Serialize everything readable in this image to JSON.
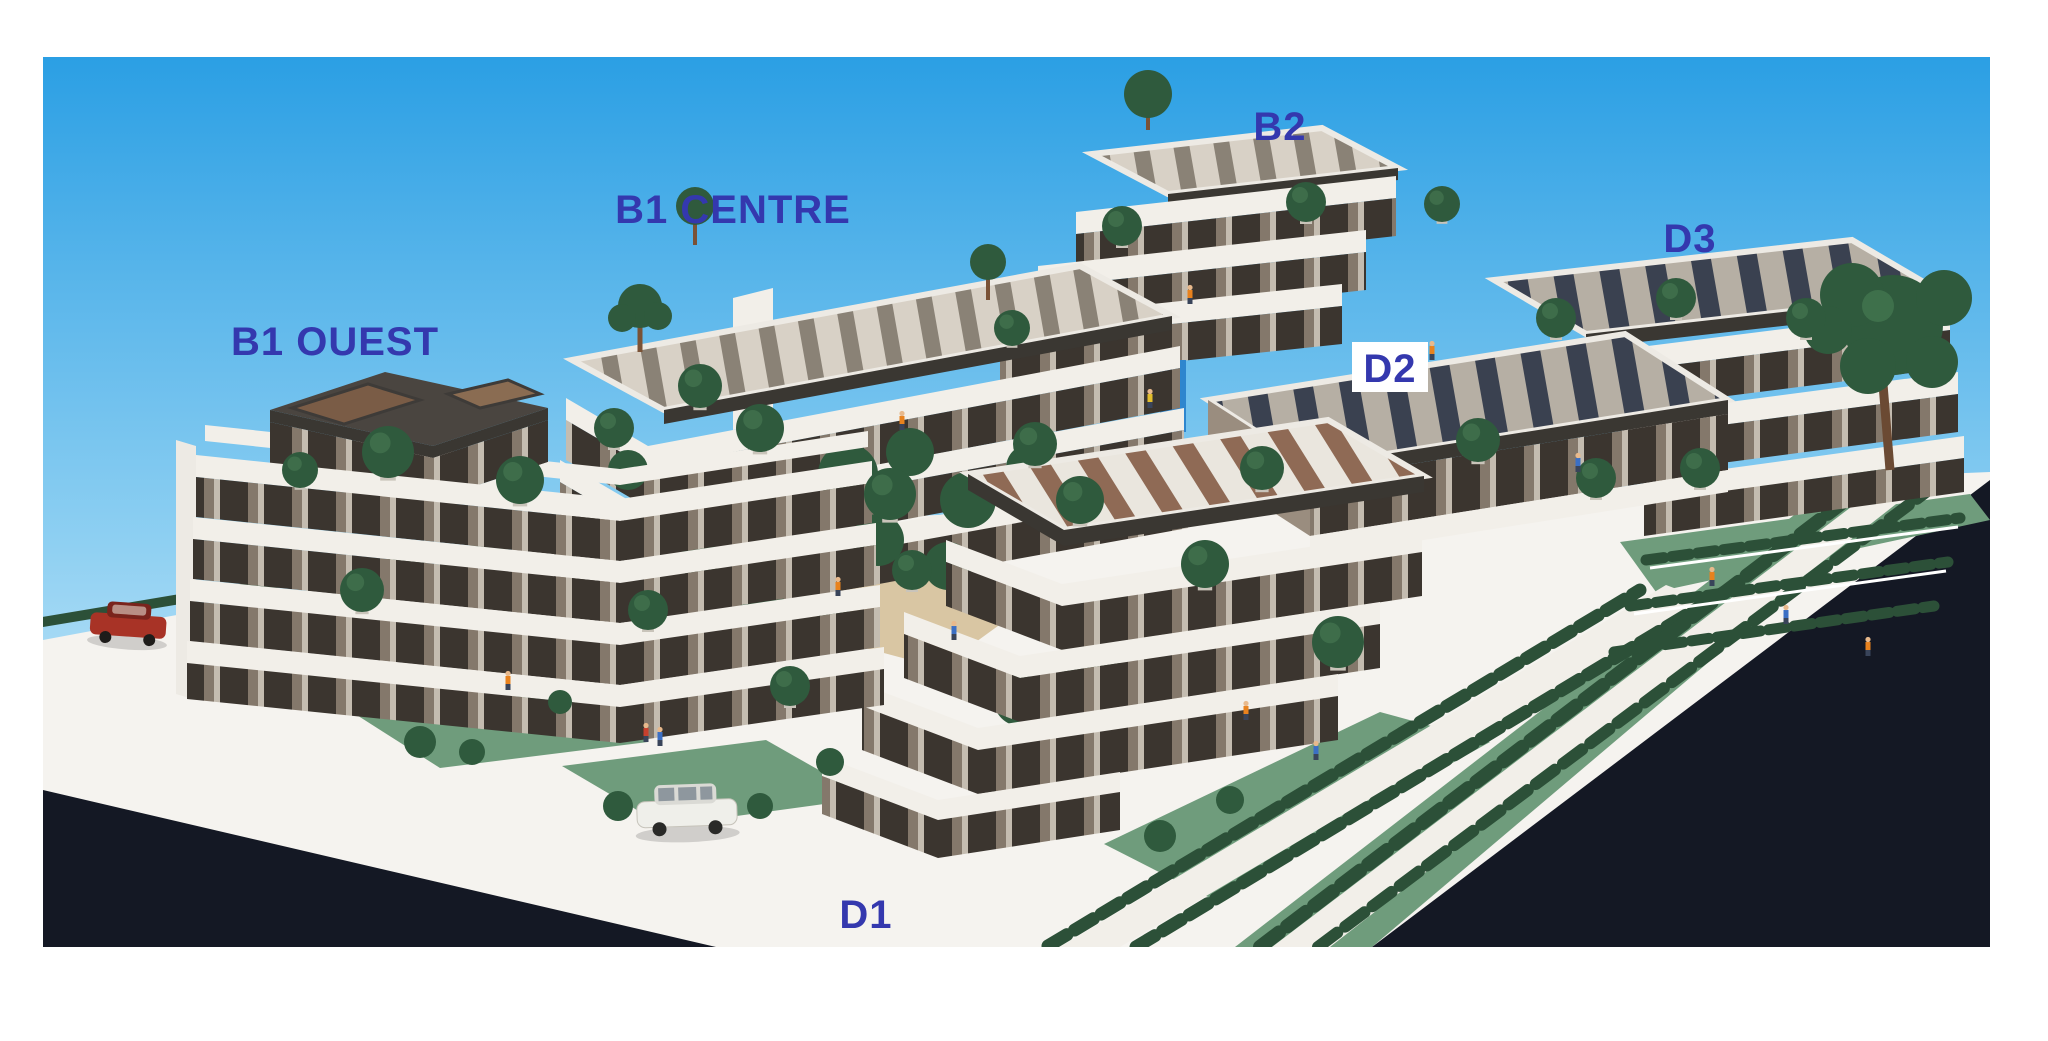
{
  "photo": {
    "alt": "Photograph of an architectural scale model of a terraced residential complex with six labeled building blocks, topiary trees, hedges, lawns, tiny figures, a red car and a white car, bordered by dark roads"
  },
  "labels": {
    "b1_ouest": "B1 OUEST",
    "b1_centre": "B1 CENTRE",
    "b2": "B2",
    "d2": "D2",
    "d3": "D3",
    "d1": "D1"
  },
  "label_style": {
    "color": "#3438AE",
    "d2_box_color": "#FFFFFF"
  },
  "colors": {
    "page_bg": "#FFFFFF",
    "sky_top": "#2B9FE4",
    "sky_mid": "#8FD0F2",
    "sky_bottom": "#E8F5FB",
    "ground": "#F5F3EF",
    "road": "#141824",
    "lawn": "#6F9C7C",
    "hedge": "#2C5038",
    "tree": "#2F5A3D",
    "tree_highlight": "#4A7E55",
    "wall_dark": "#3B352F",
    "band_white": "#F2EFE9",
    "roof_deck": "#D8D1C6",
    "roof_panel_brown": "#8F6A55",
    "roof_panel_navy": "#3A4150",
    "penthouse_glass": "#7A5C46",
    "courtyard_path": "#D9C6A3",
    "car_red": "#A83326",
    "car_white": "#EFEFEA",
    "shaft_blue": "#2E86CE"
  }
}
